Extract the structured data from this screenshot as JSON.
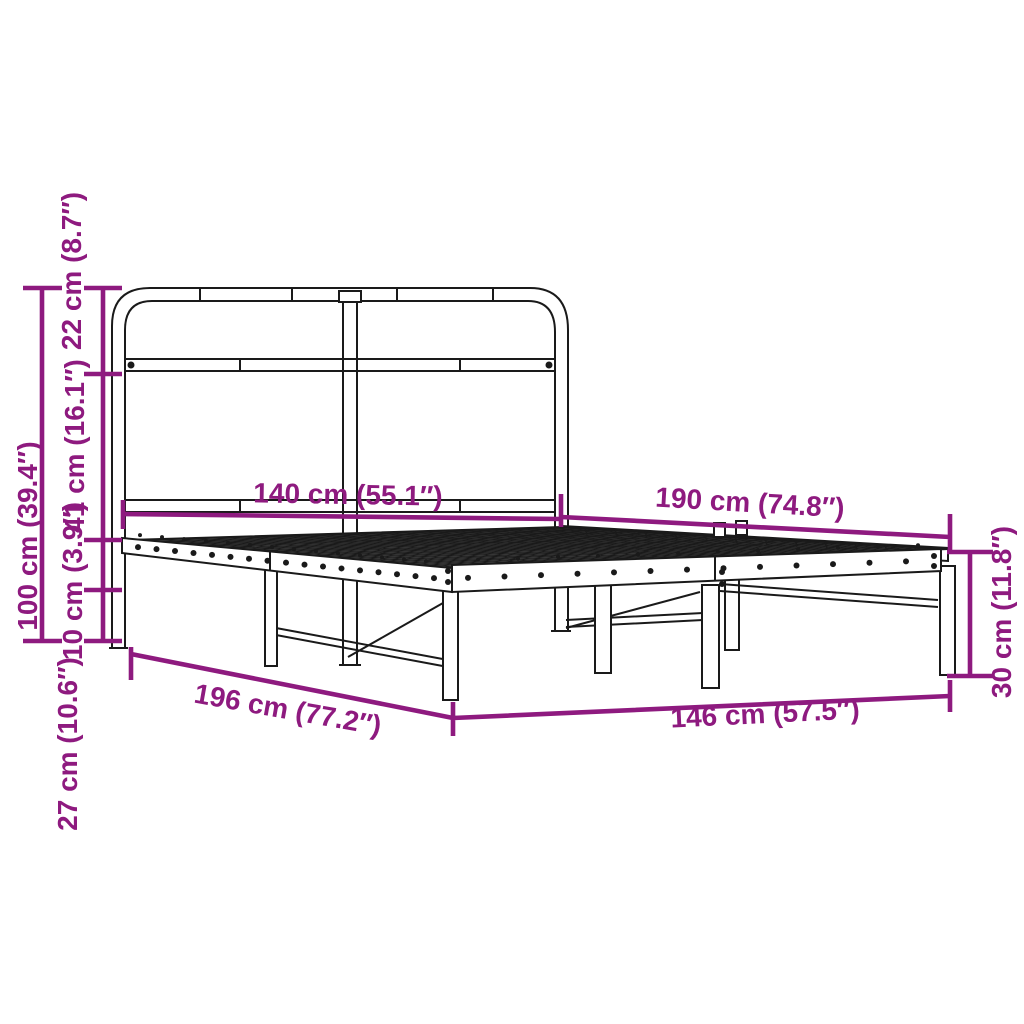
{
  "diagram": {
    "type": "product-dimension-diagram",
    "subject": "metal bed frame with headboard",
    "background": "#ffffff",
    "line_color": "#1a1a1a",
    "accent_color": "#8e1a7f",
    "dimensions": {
      "headboard_width": {
        "label": "140 cm (55.1″)",
        "cm": 140,
        "inches": 55.1
      },
      "frame_length_top": {
        "label": "190 cm (74.8″)",
        "cm": 190,
        "inches": 74.8
      },
      "headboard_height": {
        "label": "100 cm (39.4″)",
        "cm": 100,
        "inches": 39.4
      },
      "headboard_top_section": {
        "label": "22 cm (8.7″)",
        "cm": 22,
        "inches": 8.7
      },
      "headboard_mid_section": {
        "label": "41 cm (16.1″)",
        "cm": 41,
        "inches": 16.1
      },
      "rail_height": {
        "label": "10 cm (3.9″)",
        "cm": 10,
        "inches": 3.9
      },
      "under_bed_clearance": {
        "label": "27 cm (10.6″)",
        "cm": 27,
        "inches": 10.6
      },
      "overall_length": {
        "label": "196 cm (77.2″)",
        "cm": 196,
        "inches": 77.2
      },
      "overall_width": {
        "label": "146 cm (57.5″)",
        "cm": 146,
        "inches": 57.5
      },
      "footend_height": {
        "label": "30 cm (11.8″)",
        "cm": 30,
        "inches": 11.8
      }
    }
  }
}
